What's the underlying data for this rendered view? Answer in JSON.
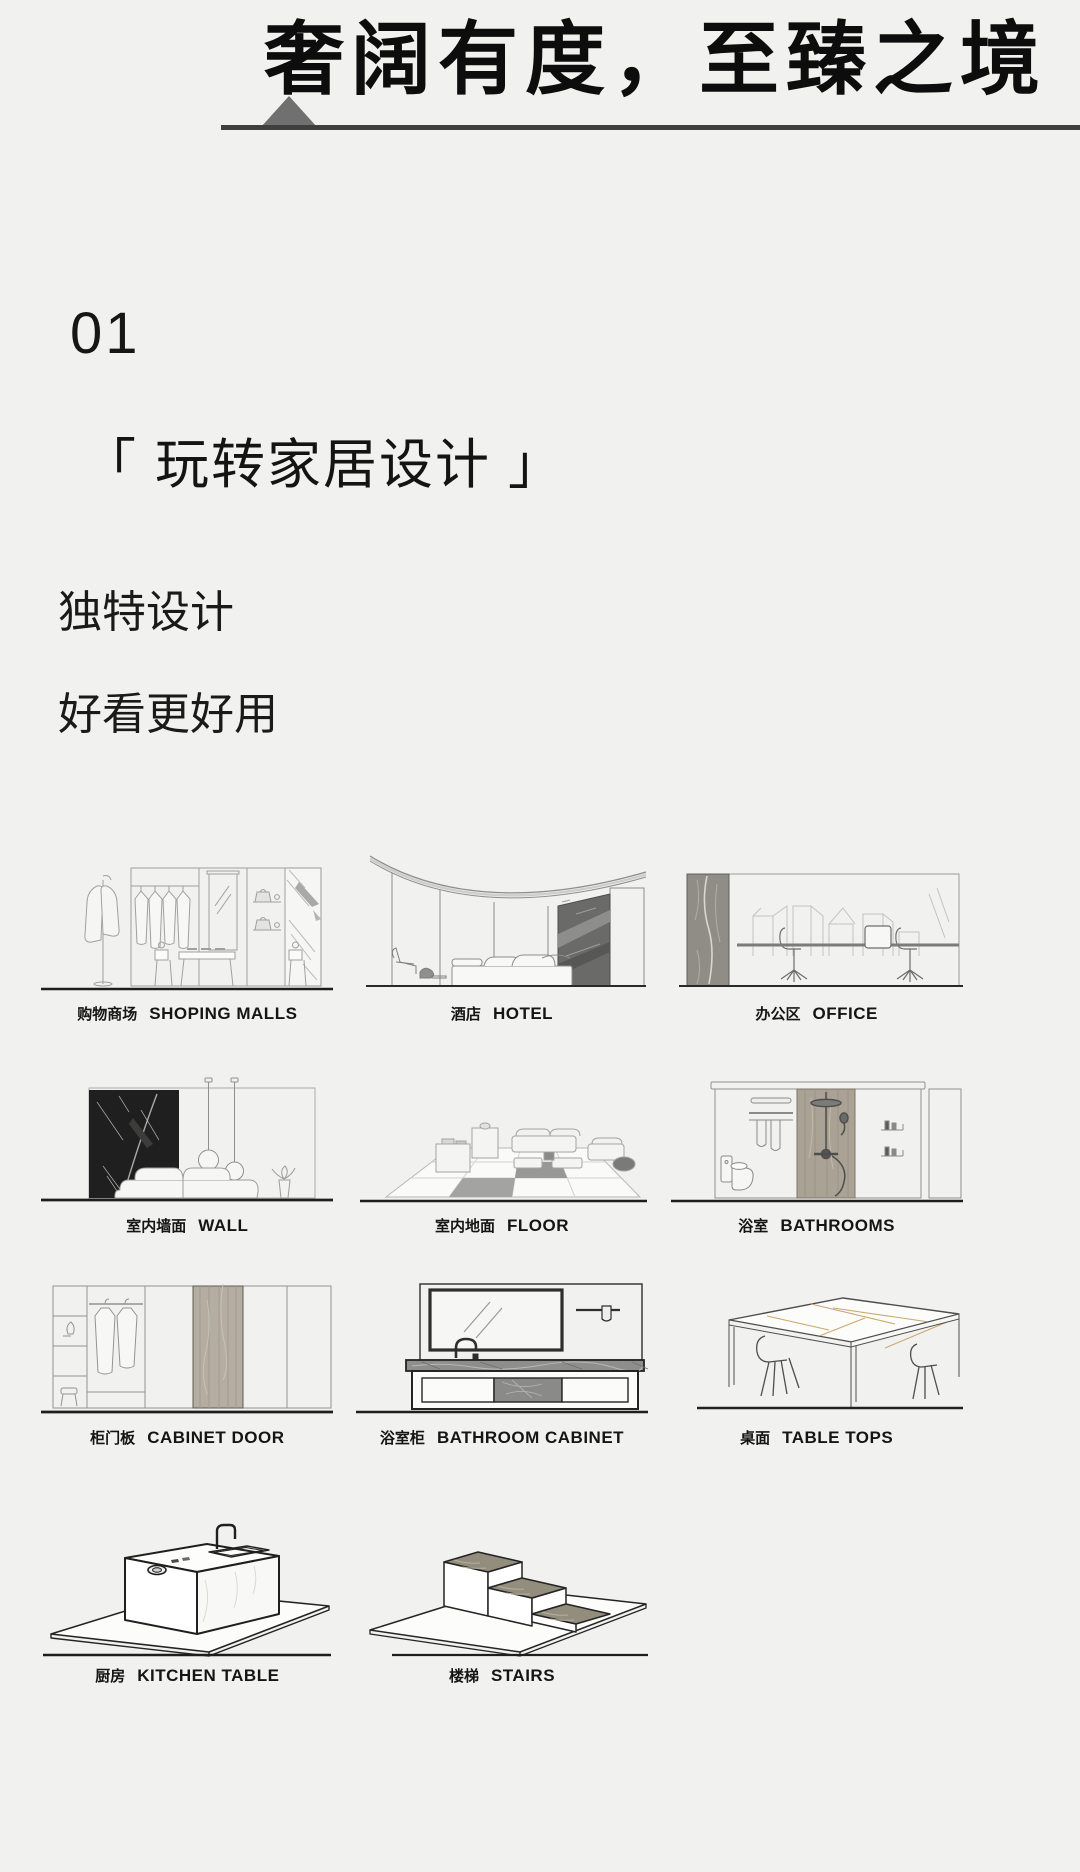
{
  "palette": {
    "background": "#f1f1ef",
    "ink": "#111111",
    "header_line": "#3f3f3f",
    "triangle": "#707070",
    "baseline": "#1e1e1e"
  },
  "header": {
    "title": "奢阔有度，至臻之境",
    "triangle_icon": "triangle-up-icon"
  },
  "section": {
    "number": "01",
    "title": "「 玩转家居设计 」",
    "line1": "独特设计",
    "line2": "好看更好用"
  },
  "categories": [
    {
      "zh": "购物商场",
      "en": "SHOPING MALLS",
      "icon": "shopping-mall-illustration"
    },
    {
      "zh": "酒店",
      "en": "HOTEL",
      "icon": "hotel-illustration"
    },
    {
      "zh": "办公区",
      "en": "OFFICE",
      "icon": "office-illustration"
    },
    {
      "zh": "室内墙面",
      "en": "WALL",
      "icon": "interior-wall-illustration"
    },
    {
      "zh": "室内地面",
      "en": "FLOOR",
      "icon": "interior-floor-illustration"
    },
    {
      "zh": "浴室",
      "en": "BATHROOMS",
      "icon": "bathroom-illustration"
    },
    {
      "zh": "柜门板",
      "en": "CABINET DOOR",
      "icon": "cabinet-door-illustration"
    },
    {
      "zh": "浴室柜",
      "en": "BATHROOM CABINET",
      "icon": "bathroom-cabinet-illustration"
    },
    {
      "zh": "桌面",
      "en": "TABLE TOPS",
      "icon": "table-tops-illustration"
    },
    {
      "zh": "厨房",
      "en": "KITCHEN TABLE",
      "icon": "kitchen-table-illustration"
    },
    {
      "zh": "楼梯",
      "en": "STAIRS",
      "icon": "stairs-illustration"
    }
  ]
}
